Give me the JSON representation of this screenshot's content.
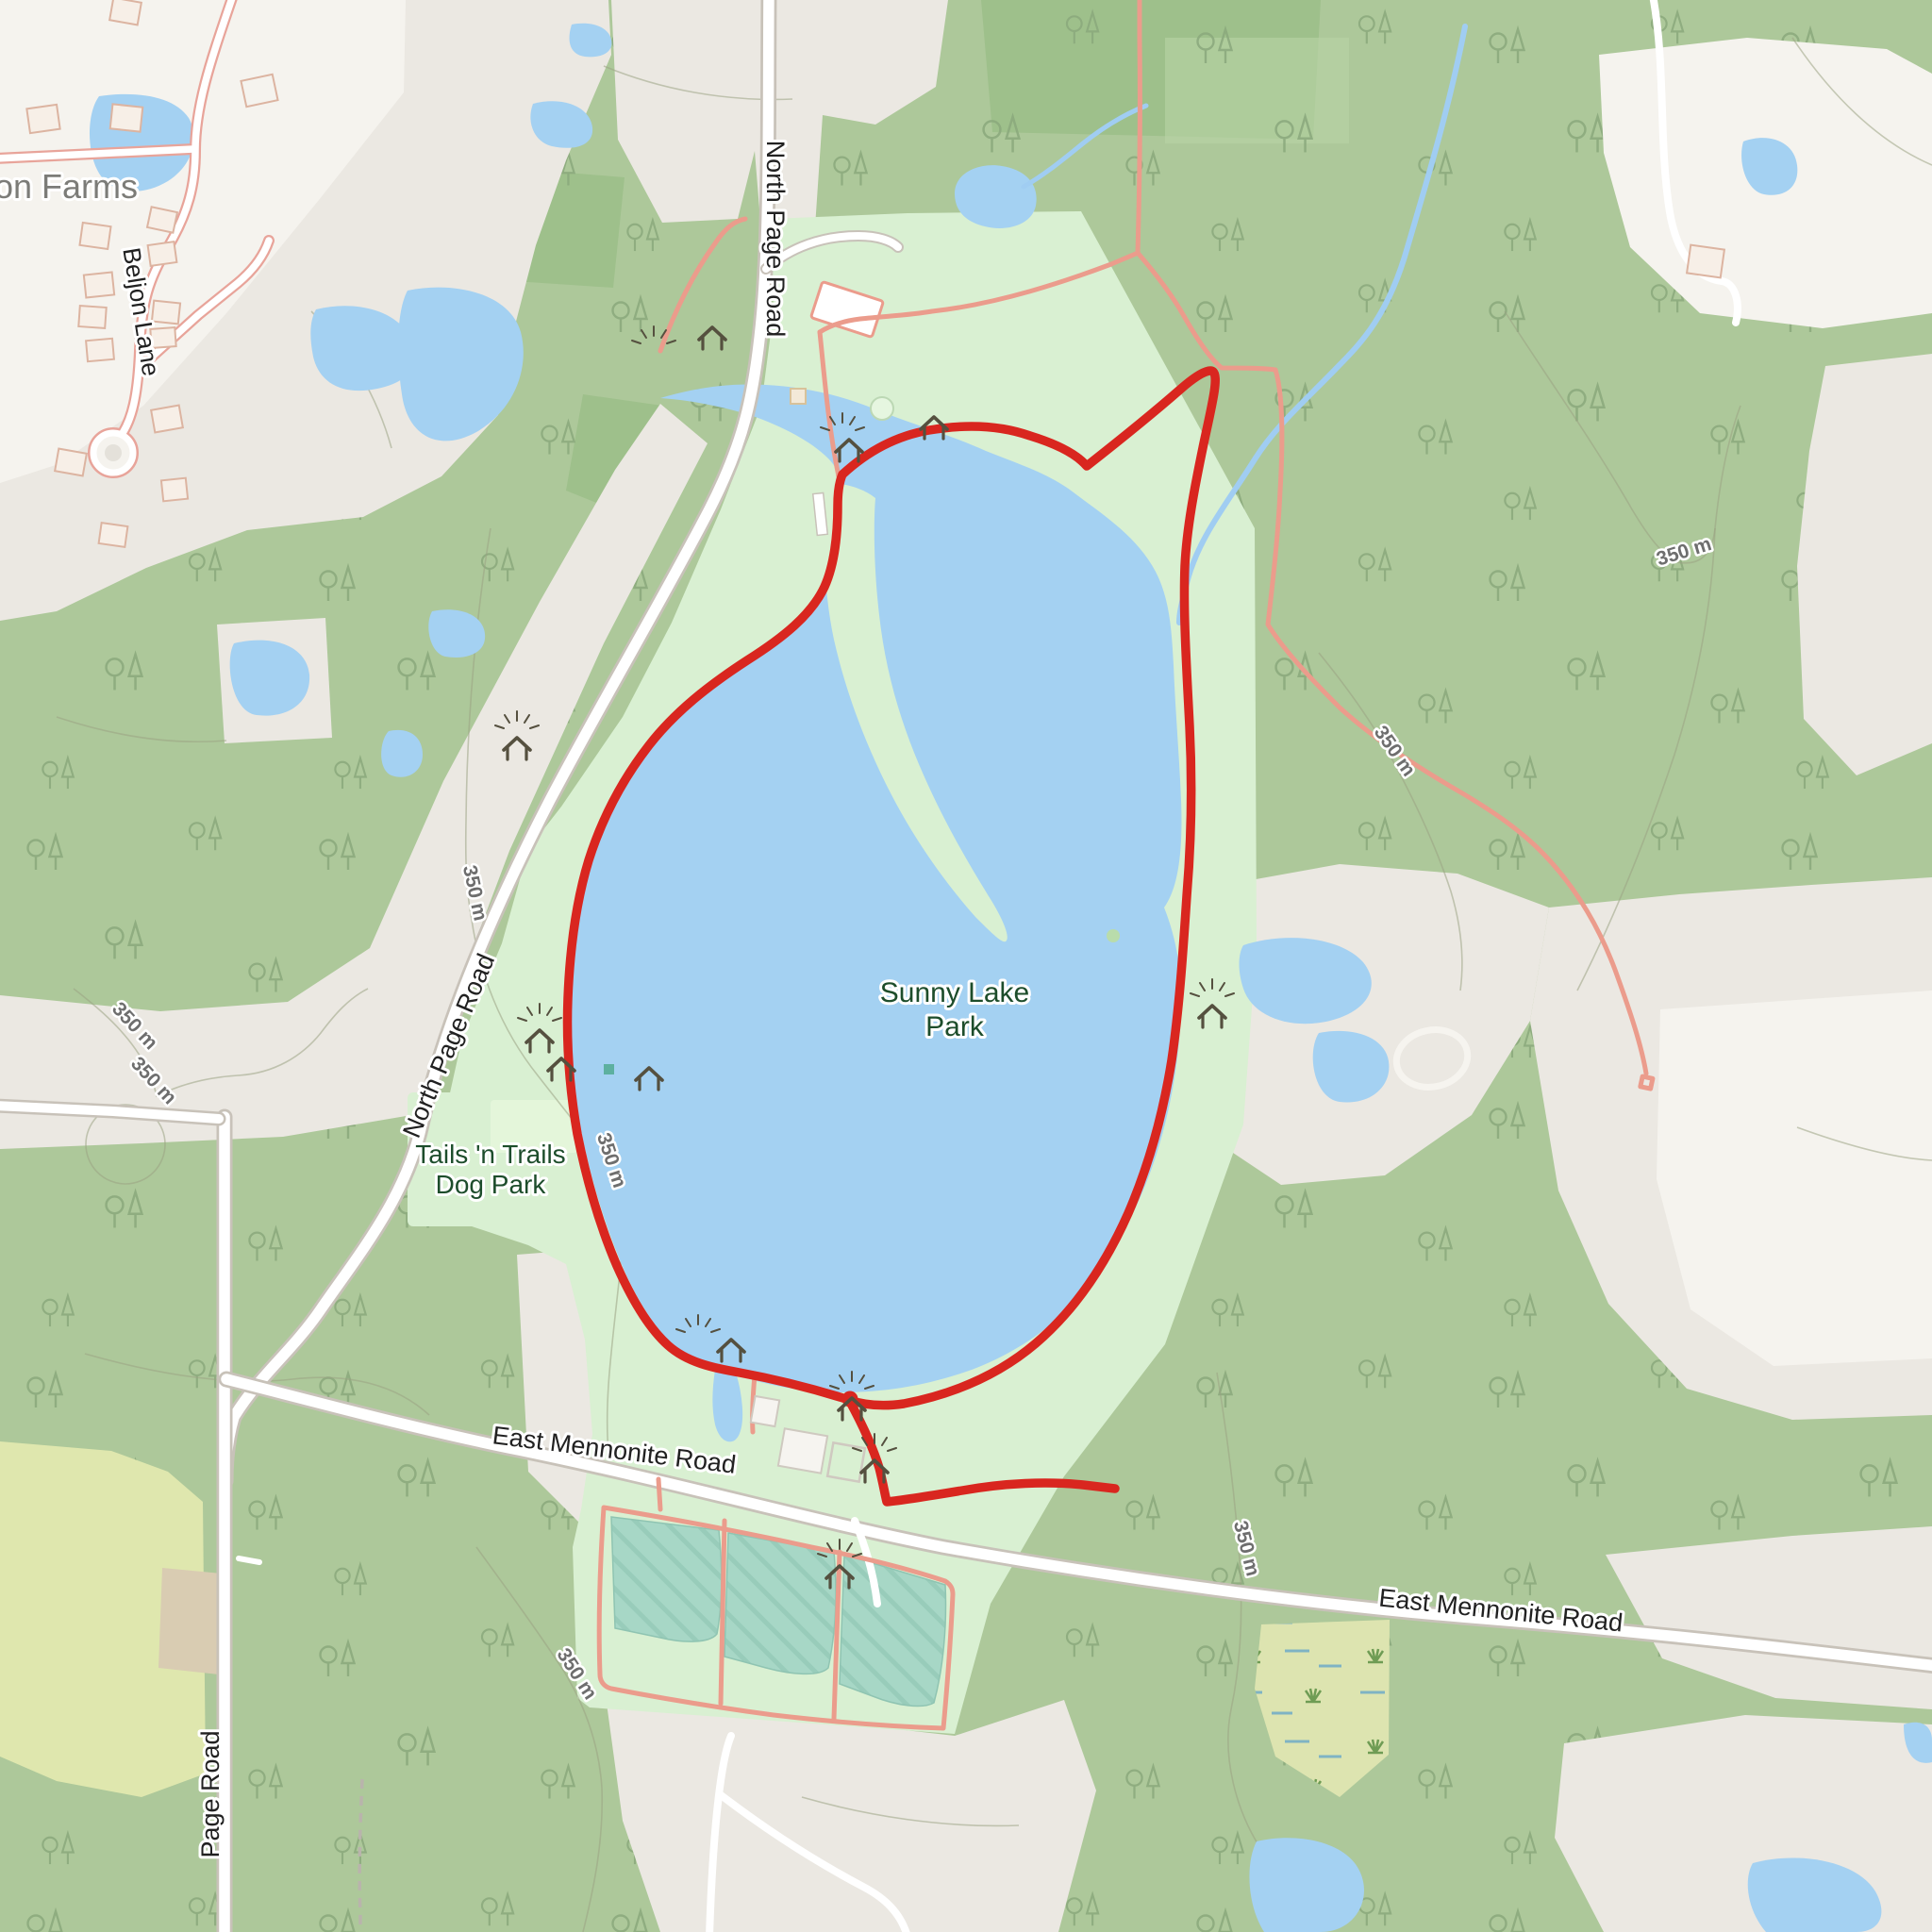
{
  "map": {
    "type": "topographic-trail-map",
    "labels": {
      "farms": "on Farms",
      "beljon": "Beljon Lane",
      "north_page_road": "North Page Road",
      "page_road": "Page Road",
      "east_mennonite_road": "East Mennonite Road",
      "sunny_lake_line1": "Sunny Lake",
      "sunny_lake_line2": "Park",
      "dog_park_line1": "Tails 'n Trails",
      "dog_park_line2": "Dog Park",
      "contour": "350 m"
    },
    "icons": {
      "picnic_shelter": "picnic-shelter",
      "firepit": "firepit",
      "playground": "playground",
      "dock": "dock",
      "parking": "parking-area",
      "trail_end_marker": "trail-end-marker"
    },
    "colors": {
      "forest": "#adc89a",
      "forest_dark": "#9ec08b",
      "open": "#ebe8e2",
      "open_white": "#f5f3ee",
      "park": "#d9f0d2",
      "park_light": "#e4f6da",
      "water": "#a4d1f2",
      "water_line": "#a0cdf2",
      "basin": "#a7d7c6",
      "marsh": "#dde4b0",
      "farmland": "#dfe7ae",
      "soil": "#d9ccb2",
      "route": "#d9261f",
      "trail": "#eb9c8c",
      "road_fill": "#ffffff",
      "road_casing": "#c8c2b9",
      "res_casing": "#e8a49a",
      "tree": "#8aa87c",
      "contour": "#9aa383",
      "building": "#f7efe7",
      "building_stroke": "#dcb4a1",
      "label_dark": "#212121",
      "label_green": "#1d4d2b",
      "label_gray": "#7c7c78",
      "contour_label": "#6e6e6e",
      "icon": "#55503f"
    }
  }
}
